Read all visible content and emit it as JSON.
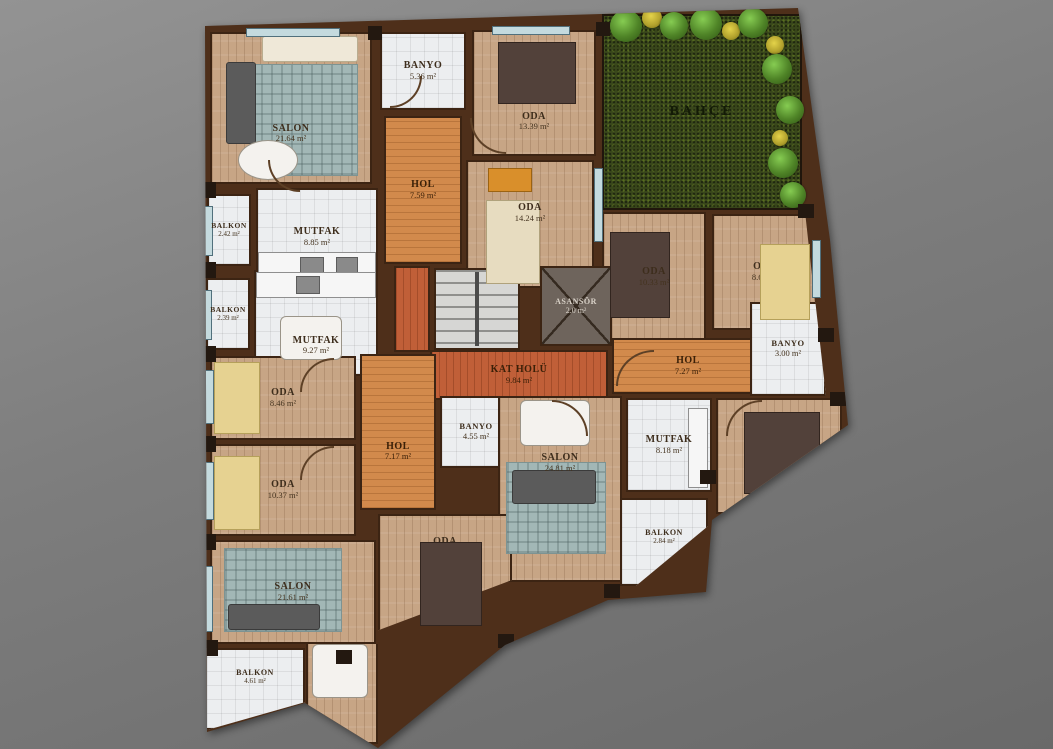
{
  "plan_title": "Kat Planı",
  "palette": {
    "wall": "#4e2f1a",
    "wood_floor": "#c7a585",
    "hall_floor": "#d28a4c",
    "landing_floor": "#c05f38",
    "tile_floor": "#eceef0",
    "garden_green": "#39471b",
    "background_gray": "#7d7d7d"
  },
  "rooms": [
    {
      "label": "SALON",
      "area": "21.64 m²"
    },
    {
      "label": "BANYO",
      "area": "5.36 m²"
    },
    {
      "label": "ODA",
      "area": "13.39 m²"
    },
    {
      "label": "BAHÇE",
      "area": ""
    },
    {
      "label": "HOL",
      "area": "7.59 m²"
    },
    {
      "label": "BALKON",
      "area": "2.42 m²"
    },
    {
      "label": "MUTFAK",
      "area": "8.85 m²"
    },
    {
      "label": "ODA",
      "area": "14.24 m²"
    },
    {
      "label": "ODA",
      "area": "10.33 m²"
    },
    {
      "label": "ODA",
      "area": "8.69 m²"
    },
    {
      "label": "BALKON",
      "area": "2.39 m²"
    },
    {
      "label": "MUTFAK",
      "area": "9.27 m²"
    },
    {
      "label": "",
      "area": ""
    },
    {
      "label": "ASANSÖR",
      "area": "2.0 m²"
    },
    {
      "label": "KAT HOLÜ",
      "area": "9.84 m²"
    },
    {
      "label": "HOL",
      "area": "7.27 m²"
    },
    {
      "label": "BANYO",
      "area": "3.00 m²"
    },
    {
      "label": "ODA",
      "area": "8.46 m²"
    },
    {
      "label": "HOL",
      "area": "7.17 m²"
    },
    {
      "label": "BANYO",
      "area": "4.55 m²"
    },
    {
      "label": "SALON",
      "area": "24.81 m²"
    },
    {
      "label": "MUTFAK",
      "area": "8.18 m²"
    },
    {
      "label": "ODA",
      "area": "14.52 m²"
    },
    {
      "label": "ODA",
      "area": "10.37 m²"
    },
    {
      "label": "ODA",
      "area": "15.63 m²"
    },
    {
      "label": "SALON",
      "area": "21.61 m²"
    },
    {
      "label": "BALKON",
      "area": "2.84 m²"
    },
    {
      "label": "BALKON",
      "area": "4.61 m²"
    }
  ]
}
